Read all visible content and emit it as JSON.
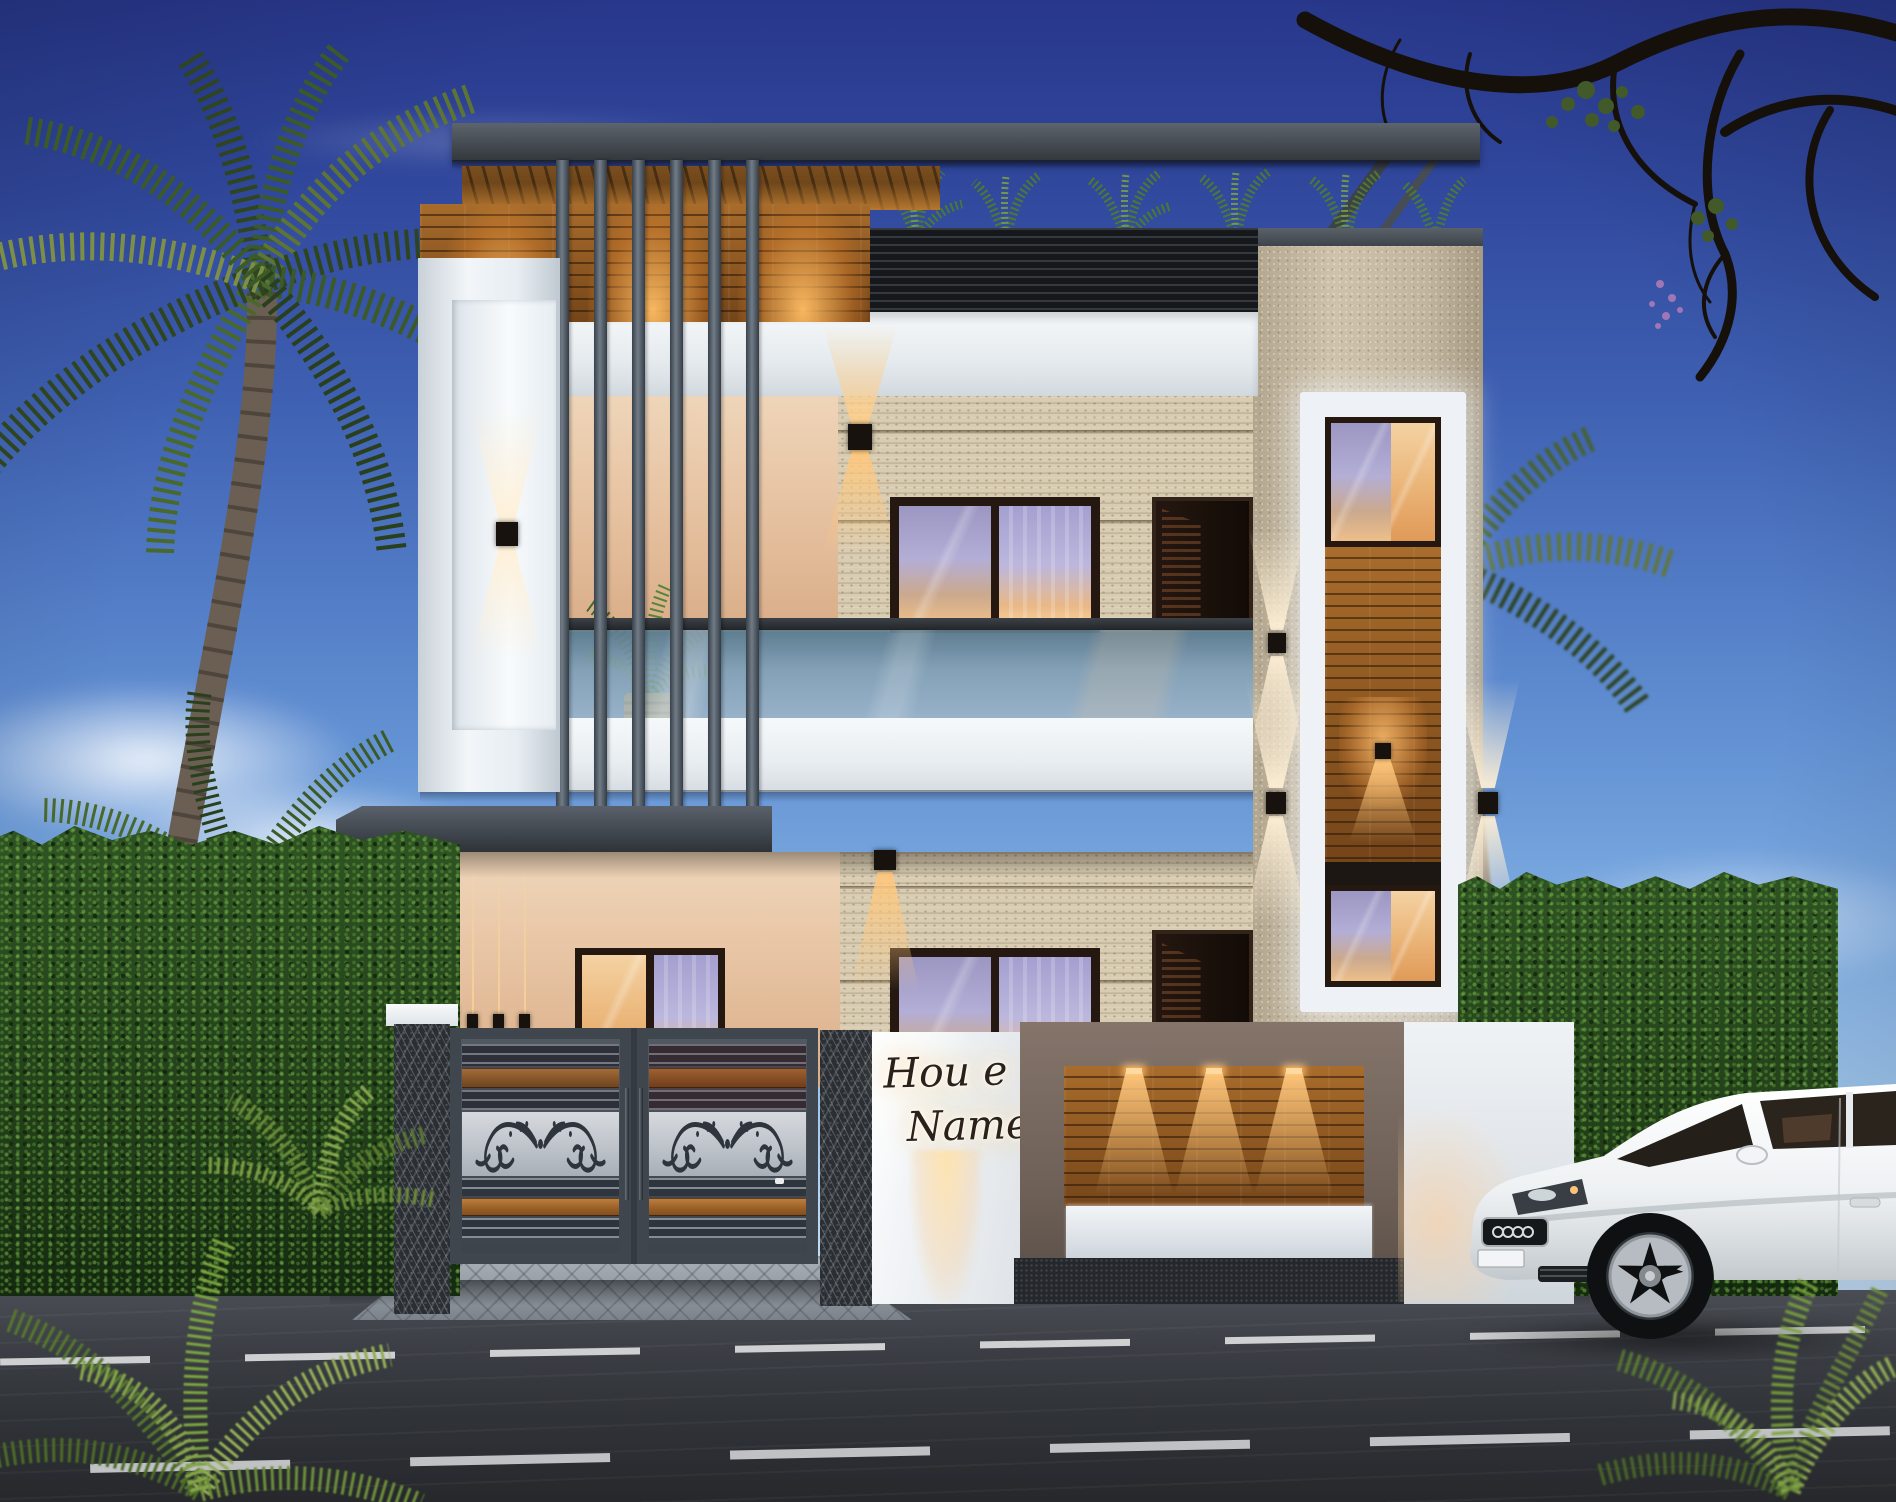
{
  "sign": {
    "line1": "Hou e",
    "line2": "Name"
  },
  "palette": {
    "sky_top": "#28378b",
    "sky_horizon": "#d6eafa",
    "roof_gray": "#42484f",
    "slat_gray": "#5c6670",
    "wood": "#9a6327",
    "wood_deep": "#74451a",
    "travertine": "#d8ccb2",
    "peach_wall": "#e5c09e",
    "white_trim": "#eef2f6",
    "stucco_beige": "#c6b9a1",
    "taupe_wall": "#77675e",
    "marble_dark": "#2b2f34",
    "gate_gray": "#4b525b",
    "silver_band": "#c7ccd2",
    "hedge_green": "#26431c",
    "palm_green": "#3c5a28",
    "road_asphalt": "#34373c",
    "lane_marking": "#e8e9ea",
    "glass_blue": "#9fb4bd",
    "curtain_lavender": "#aca7d0",
    "warm_light": "#ffbe6e",
    "car_white": "#f2f4f6",
    "sign_ink": "#2b2118"
  }
}
